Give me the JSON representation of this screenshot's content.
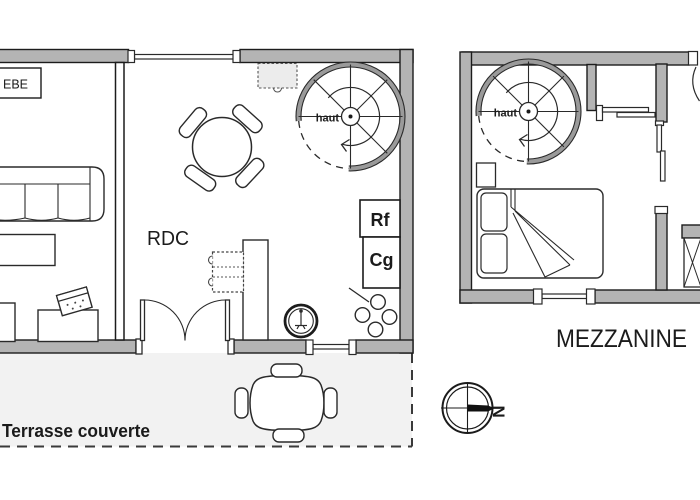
{
  "document": {
    "kind": "architectural-floor-plan",
    "floors": [
      "RDC",
      "MEZZANINE"
    ]
  },
  "labels": {
    "ground_floor": "RDC",
    "mezzanine": "MEZZANINE",
    "terrace": "Terrasse couverte",
    "stairs_up_rdc": "haut",
    "stairs_up_mezzanine": "haut",
    "fridge": "Rf",
    "freezer": "Cg",
    "crib": "EBE",
    "compass_north": "N"
  },
  "colors": {
    "wall_fill": "#b4b4b4",
    "line": "#222222",
    "terrace_background": "#f2f2f2",
    "background": "#ffffff",
    "cabinet_fill": "#ececec"
  }
}
